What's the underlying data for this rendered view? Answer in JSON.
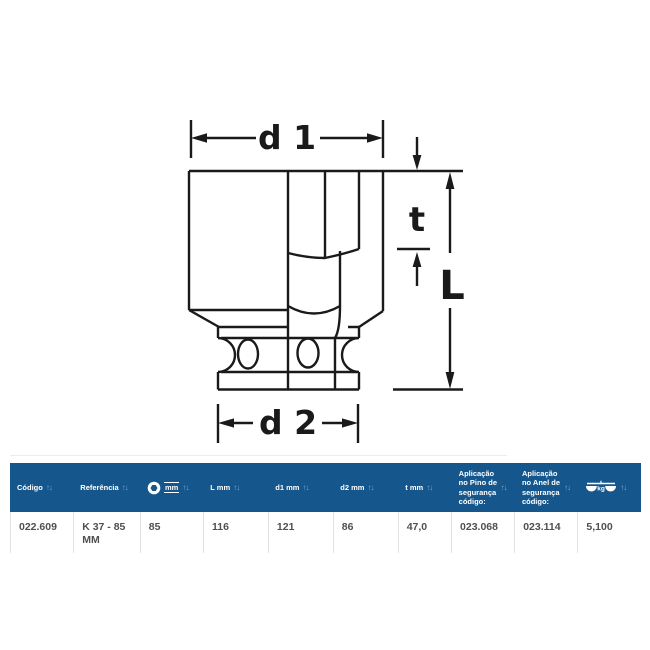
{
  "diagram": {
    "d1_label": "d 1",
    "d2_label": "d 2",
    "t_label": "t",
    "L_label": "L"
  },
  "table": {
    "sort_icon": "↑↓",
    "columns": [
      {
        "label": "Código"
      },
      {
        "label": "Referência"
      },
      {
        "label": "mm",
        "icon": "hex-nut-icon"
      },
      {
        "label": "L mm"
      },
      {
        "label": "d1 mm"
      },
      {
        "label": "d2 mm"
      },
      {
        "label": "t mm"
      },
      {
        "label": "Aplicação no Pino de segurança código:"
      },
      {
        "label": "Aplicação no Anel de segurança código:"
      },
      {
        "label": "kg",
        "icon": "scale-icon"
      }
    ],
    "row": [
      "022.609",
      "K 37 - 85 MM",
      "85",
      "116",
      "121",
      "86",
      "47,0",
      "023.068",
      "023.114",
      "5,100"
    ]
  },
  "colors": {
    "header_bg": "#15578d",
    "header_text": "#ffffff",
    "sort_icon": "#7fa3c9",
    "row_text": "#4f4f4f",
    "cell_border": "#e2e2e2",
    "drawing_line": "#1a1a1a",
    "background": "#ffffff"
  }
}
